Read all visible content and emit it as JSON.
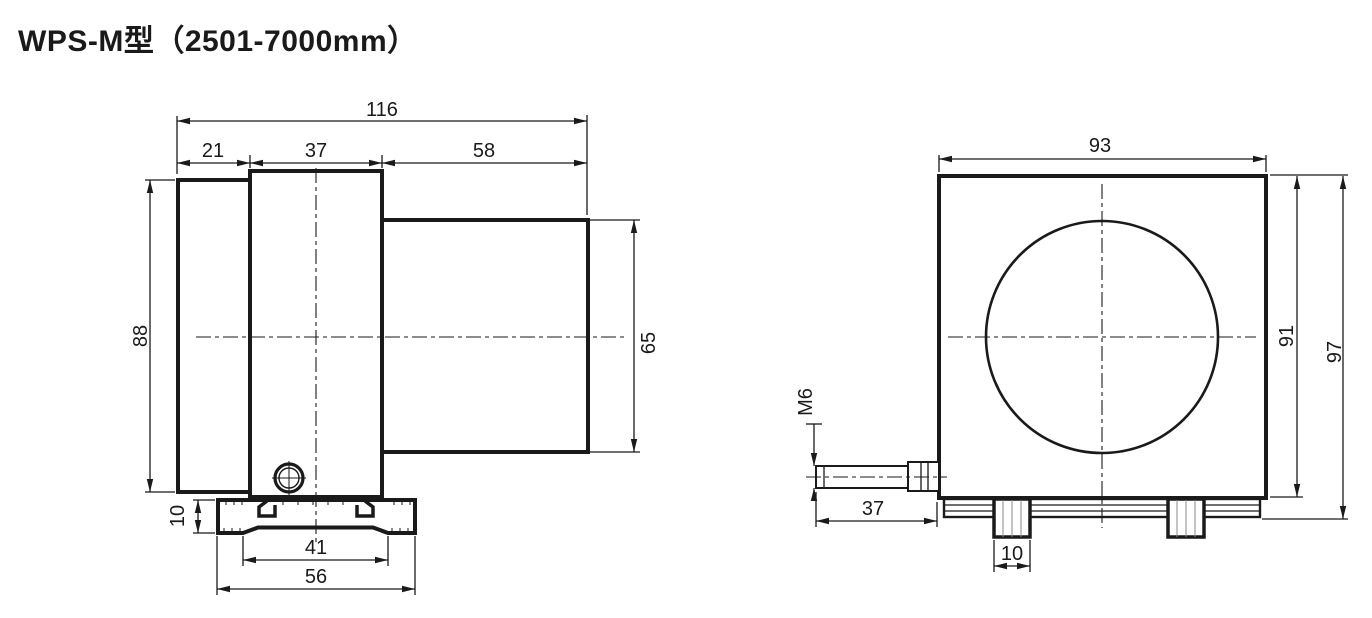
{
  "title": "WPS-M型（2501-7000mm）",
  "drawing": {
    "side_view": {
      "dims": {
        "total_width": "116",
        "segment_a": "21",
        "segment_b": "37",
        "segment_c": "58",
        "body_height": "88",
        "sensor_height": "65",
        "base_thickness": "10",
        "base_inner_width": "41",
        "base_width": "56"
      }
    },
    "front_view": {
      "dims": {
        "body_width": "93",
        "body_height": "91",
        "overall_height": "97",
        "thread_spec": "M6",
        "rod_length": "37",
        "foot_width": "10"
      }
    },
    "colors": {
      "ink": "#1a1a1a",
      "background": "#ffffff"
    }
  }
}
